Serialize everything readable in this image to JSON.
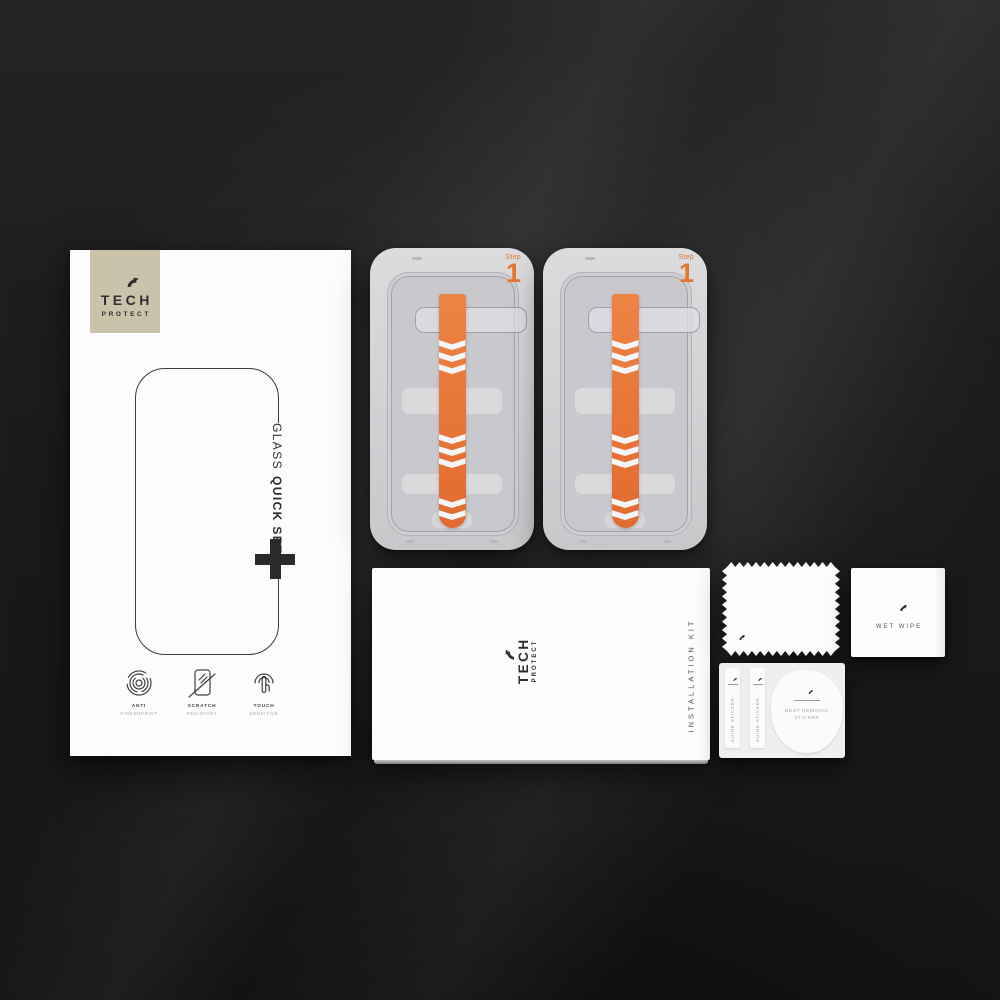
{
  "brand": {
    "line1": "TECH",
    "line2": "PROTECT",
    "logo_icon": "tech-protect-hexagon-icon"
  },
  "package": {
    "title_regular": "GLASS",
    "title_bold": "QUICK SET",
    "plus_symbol_icon": "plus-icon",
    "features": [
      {
        "icon": "anti-fingerprint-icon",
        "line1": "ANTI",
        "line2": "FINGERPRINT"
      },
      {
        "icon": "scratch-resistant-icon",
        "line1": "SCRATCH",
        "line2": "RESISTANT"
      },
      {
        "icon": "touch-sensitive-icon",
        "line1": "TOUCH",
        "line2": "SENSITIVE"
      }
    ]
  },
  "applicator_trays": [
    {
      "step_label": "Step",
      "step_number": "1",
      "arrow_icon": "pull-tab-arrow-icon"
    },
    {
      "step_label": "Step",
      "step_number": "1",
      "arrow_icon": "pull-tab-arrow-icon"
    }
  ],
  "installation_box": {
    "brand_line1": "TECH",
    "brand_line2": "PROTECT",
    "side_label": "INSTALLATION KIT"
  },
  "wet_wipe": {
    "icon": "hexagon-logo-icon",
    "label": "WET WIPE"
  },
  "sticker_sheet": {
    "guide_stickers": [
      {
        "label": "GUIDE STICKER"
      },
      {
        "label": "GUIDE STICKER"
      }
    ],
    "dust_sticker": {
      "line1": "DUST REMOVAL",
      "line2": "STICKER"
    }
  },
  "colors": {
    "accent_orange": "#E4762F",
    "logo_beige": "#CBC3A9",
    "tray_gray": "#D4D4D7",
    "background": "#1A1A1C"
  }
}
